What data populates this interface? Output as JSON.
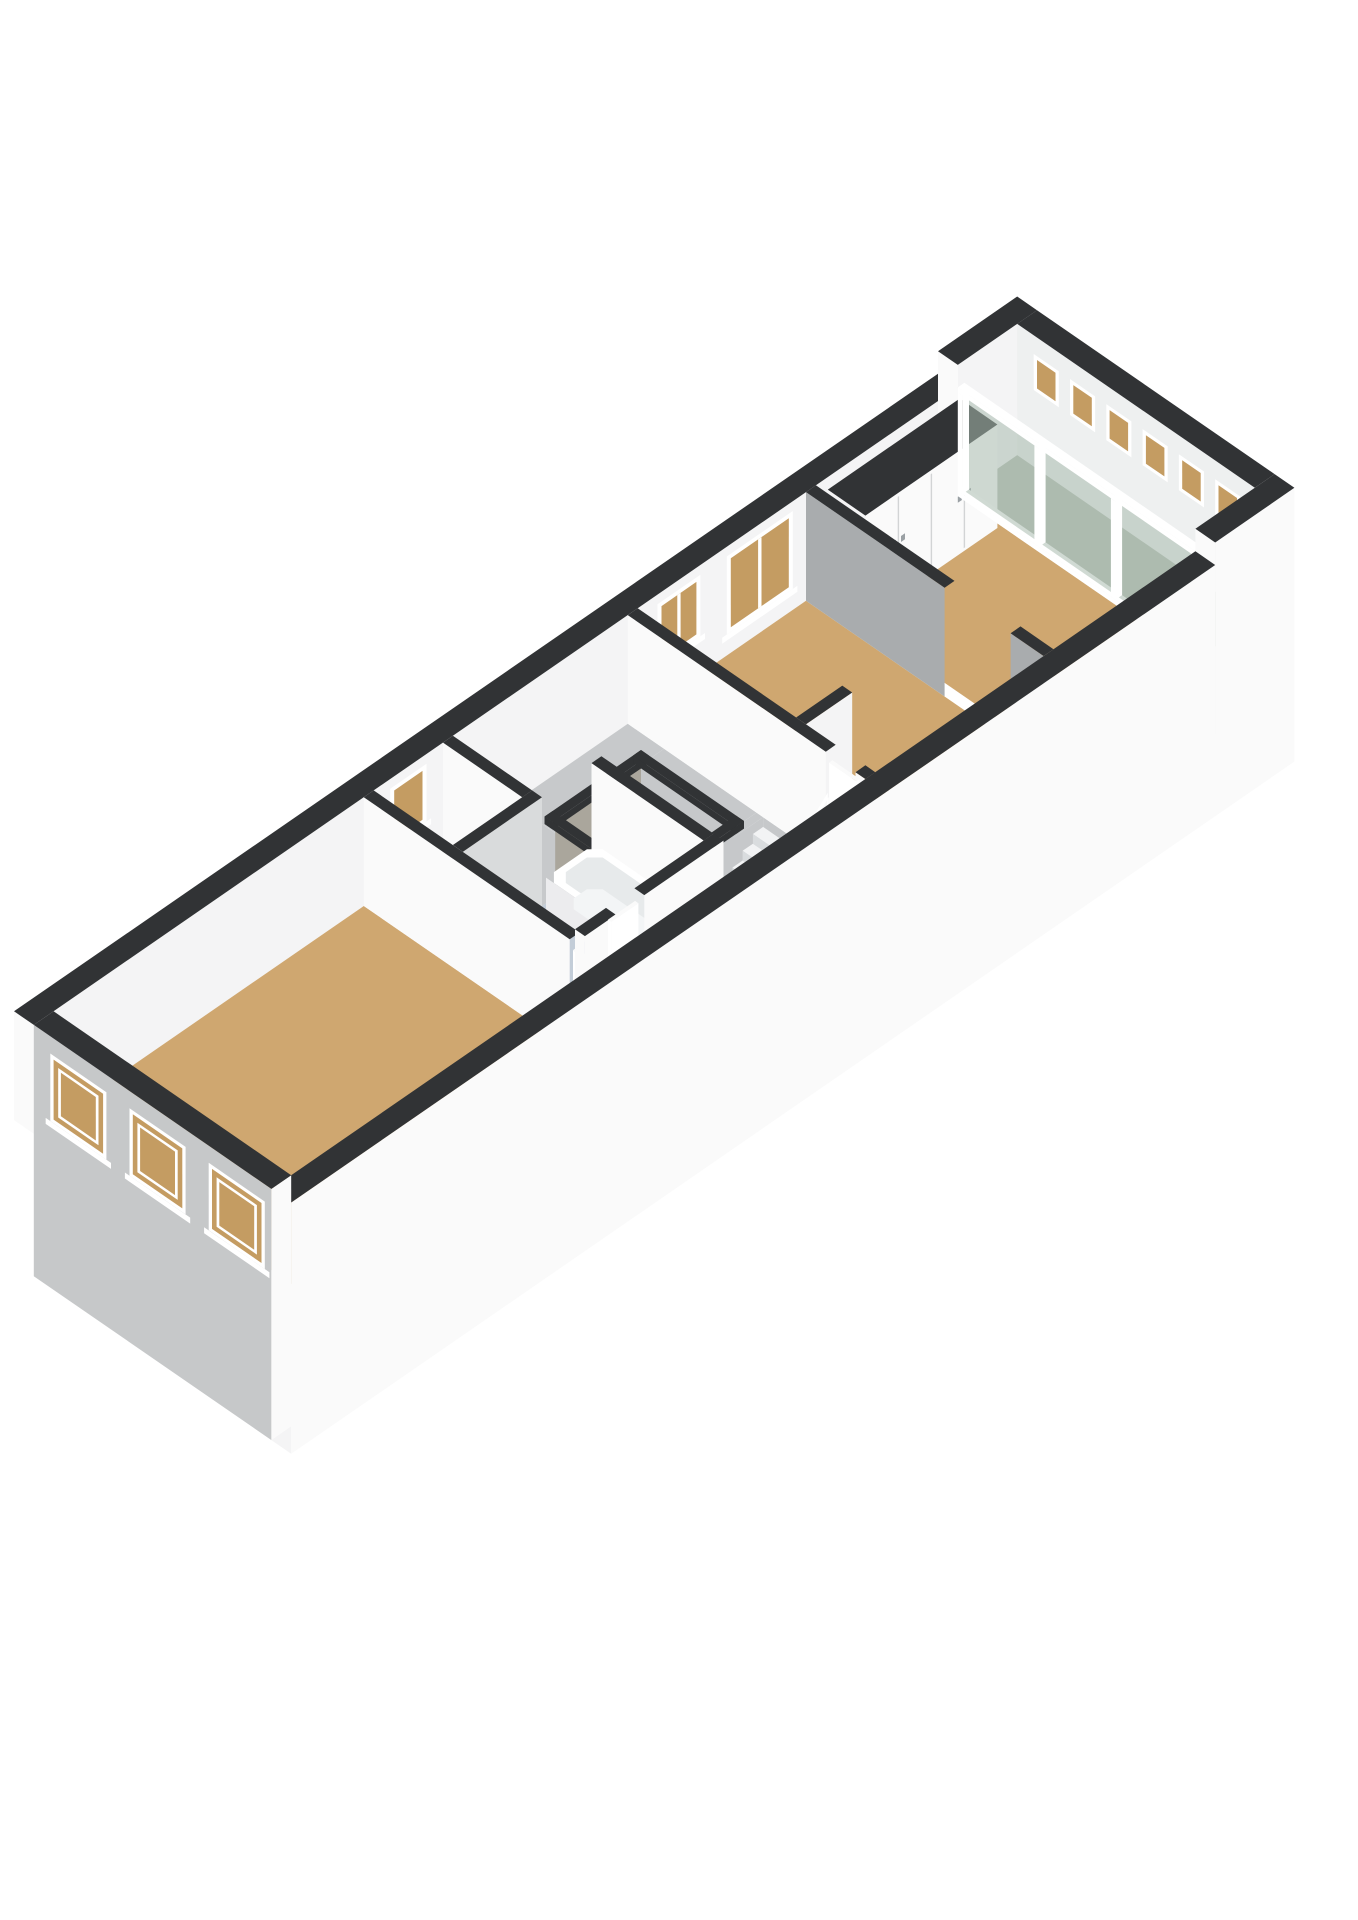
{
  "scene": {
    "width": 1358,
    "height": 1920,
    "background": "#ffffff"
  },
  "projection": {
    "ox": 14,
    "oy": 1120,
    "k": 66,
    "slope": 0.69,
    "hk": 75
  },
  "palette": {
    "capDark": "#313335",
    "wallWhite": "#f4f4f5",
    "wallWhiteB": "#fafafa",
    "wallShadowGray": "#a9acae",
    "wallLightGray": "#d9dbdc",
    "facadeGray": "#c6c8c9",
    "endFaceWhite": "#eef0f0",
    "floorTan": "#cfa770",
    "floorBath": "#c3cdd8",
    "floorToilet": "#b2b4b6",
    "floorGrayHall": "#c7c9cb",
    "floorLoggia": "#b2bab0",
    "pitFloor": "#94979a",
    "pitWall": "#c6c8ca",
    "pitWallB": "#aaa69c",
    "deepPit": "#84878a",
    "glassGreen": "#a9bbae",
    "glassAmber": "#c49c62",
    "tread": "#f2f3f4",
    "riser": "#d9dcde",
    "stairSide": "#e9ebec",
    "white": "#ffffff",
    "handle": "#9aa0a4",
    "doorGap": "#d2d4d5",
    "tubSide": "#fafbfb",
    "tubEnd": "#ececee",
    "tubInner": "#e7eaeb",
    "tubBottom": "#f3f5f6"
  },
  "elements": [
    {
      "type": "wall",
      "name": "ext-wall-top-left-main",
      "axis": "a",
      "a0": 0,
      "a1": 14.0,
      "b0": 0,
      "b1": 0.3,
      "h": 1.45,
      "side": "wallWhite",
      "end": "wallWhiteB",
      "cap": "capDark"
    },
    {
      "type": "wall",
      "name": "ext-wall-top-left-end",
      "axis": "a",
      "a0": 14.0,
      "a1": 15.2,
      "b0": 0,
      "b1": 0.3,
      "h": 1.75,
      "side": "wallWhite",
      "end": "wallWhiteB",
      "cap": "capDark"
    },
    {
      "type": "windowB",
      "name": "toilet-window",
      "b": 0.3,
      "a0": 5.4,
      "a1": 5.95,
      "h0": 0.55,
      "h1": 1.32,
      "mull": 0
    },
    {
      "type": "windowB",
      "name": "bedroom2-window-small",
      "b": 0.3,
      "a0": 9.45,
      "a1": 10.1,
      "h0": 0.5,
      "h1": 1.32,
      "mull": 1
    },
    {
      "type": "windowB",
      "name": "bedroom2-window-large",
      "b": 0.3,
      "a0": 10.5,
      "a1": 11.5,
      "h0": 0.28,
      "h1": 1.32,
      "mull": 1
    },
    {
      "type": "wall",
      "name": "ext-wall-rear-end",
      "axis": "b",
      "a0": 14.9,
      "a1": 15.2,
      "b0": 0.3,
      "b1": 3.9,
      "h": 1.75,
      "side": "endFaceWhite",
      "end": "wallWhiteB",
      "cap": "capDark",
      "ext": 1
    },
    {
      "type": "windowA",
      "name": "transom-window-1",
      "a": 14.9,
      "b0": 0.55,
      "b1": 0.93,
      "h0": 1.02,
      "h1": 1.5
    },
    {
      "type": "windowA",
      "name": "transom-window-2",
      "a": 14.9,
      "b0": 1.1,
      "b1": 1.48,
      "h0": 1.02,
      "h1": 1.5
    },
    {
      "type": "windowA",
      "name": "transom-window-3",
      "a": 14.9,
      "b0": 1.65,
      "b1": 2.03,
      "h0": 1.02,
      "h1": 1.5
    },
    {
      "type": "windowA",
      "name": "transom-window-4",
      "a": 14.9,
      "b0": 2.2,
      "b1": 2.58,
      "h0": 1.02,
      "h1": 1.5
    },
    {
      "type": "windowA",
      "name": "transom-window-5",
      "a": 14.9,
      "b0": 2.75,
      "b1": 3.13,
      "h0": 1.02,
      "h1": 1.5
    },
    {
      "type": "windowA",
      "name": "transom-window-6",
      "a": 14.9,
      "b0": 3.3,
      "b1": 3.68,
      "h0": 1.02,
      "h1": 1.5
    },
    {
      "type": "floor",
      "name": "front-room-floor",
      "a0": 0.3,
      "a1": 5.0,
      "b0": 0.3,
      "b1": 3.9,
      "color": "floorTan"
    },
    {
      "type": "floor",
      "name": "toilet-room-floor",
      "a0": 5.15,
      "a1": 6.2,
      "b0": 0.3,
      "b1": 1.5,
      "color": "floorToilet"
    },
    {
      "type": "floor",
      "name": "bathroom-floor",
      "a0": 5.15,
      "a1": 7.1,
      "b0": 1.65,
      "b1": 3.35,
      "color": "floorBath"
    },
    {
      "type": "floor",
      "name": "front-hall-floor",
      "a0": 5.15,
      "a1": 7.25,
      "b0": 3.5,
      "b1": 3.9,
      "color": "floorTan"
    },
    {
      "type": "floor",
      "name": "mid-corridor-floor",
      "a0": 6.35,
      "a1": 7.25,
      "b0": 0.3,
      "b1": 1.65,
      "color": "floorGrayHall"
    },
    {
      "type": "floor",
      "name": "stairhall-floor-strip-1",
      "a0": 7.25,
      "a1": 9.0,
      "b0": 0.3,
      "b1": 0.85,
      "color": "floorGrayHall"
    },
    {
      "type": "floor",
      "name": "stairhall-floor-strip-2",
      "a0": 7.25,
      "a1": 7.35,
      "b0": 0.85,
      "b1": 2.25,
      "color": "floorGrayHall"
    },
    {
      "type": "floor",
      "name": "stairhall-floor-strip-3",
      "a0": 8.65,
      "a1": 9.0,
      "b0": 0.85,
      "b1": 2.25,
      "color": "floorGrayHall"
    },
    {
      "type": "floor",
      "name": "stairhall-floor-strip-4",
      "a0": 7.25,
      "a1": 9.0,
      "b0": 2.25,
      "b1": 2.35,
      "color": "floorGrayHall"
    },
    {
      "type": "floor",
      "name": "stairhall-floor-strip-5",
      "a0": 7.25,
      "a1": 7.6,
      "b0": 2.35,
      "b1": 3.3,
      "color": "floorGrayHall"
    },
    {
      "type": "floor",
      "name": "stair-landing-floor",
      "a0": 7.25,
      "a1": 9.0,
      "b0": 3.3,
      "b1": 3.9,
      "color": "floorTan"
    },
    {
      "type": "floor",
      "name": "bedroom2-floor",
      "a0": 9.15,
      "a1": 11.7,
      "b0": 0.3,
      "b1": 3.9,
      "color": "floorTan"
    },
    {
      "type": "floor",
      "name": "bedroom3-floor",
      "a0": 11.85,
      "a1": 14.0,
      "b0": 0.3,
      "b1": 3.9,
      "color": "floorTan"
    },
    {
      "type": "floor",
      "name": "loggia-floor",
      "a0": 14.1,
      "a1": 14.9,
      "b0": 0.3,
      "b1": 3.9,
      "color": "floorLoggia"
    },
    {
      "type": "voidshaft",
      "name": "vide-opening",
      "a0": 7.35,
      "a1": 8.65,
      "b0": 0.85,
      "b1": 2.25,
      "depth": 0.8
    },
    {
      "type": "stairwell",
      "name": "stairwell-opening",
      "a0": 7.6,
      "a1": 9.0,
      "b0": 2.35,
      "b1": 3.3,
      "depth": 1.05
    },
    {
      "type": "closet",
      "name": "wardrobe-closet",
      "a0": 11.95,
      "a1": 13.95,
      "b0": 0.38,
      "b1": 0.95,
      "h": 1.38
    },
    {
      "type": "glasswall",
      "name": "loggia-glass-wall",
      "a0": 14.0,
      "a1": 14.1,
      "b0": 0.3,
      "b1": 3.9,
      "h": 1.45
    },
    {
      "type": "wall",
      "name": "wall-bedroom3-divider",
      "axis": "b",
      "a0": 11.7,
      "a1": 11.85,
      "b0": 0.3,
      "b1": 3.9,
      "h": 1.45,
      "side": "wallShadowGray",
      "end": "wallWhite",
      "cap": "capDark",
      "open": [
        [
          2.4,
          3.4
        ]
      ]
    },
    {
      "type": "wall",
      "name": "bedroom2-closet-stub",
      "axis": "a",
      "a0": 9.15,
      "a1": 9.85,
      "b0": 2.7,
      "b1": 2.85,
      "h": 1.45,
      "side": "wallWhite",
      "end": "wallWhiteB",
      "cap": "capDark"
    },
    {
      "type": "wall",
      "name": "wall-stairhall-bedroom2",
      "axis": "b",
      "a0": 9.0,
      "a1": 9.15,
      "b0": 0.3,
      "b1": 3.9,
      "h": 1.45,
      "side": "wallWhiteB",
      "end": "wallWhite",
      "cap": "capDark",
      "open": [
        [
          3.3,
          3.75
        ]
      ]
    },
    {
      "type": "doorleaf",
      "name": "bedroom2-door",
      "axis": "b",
      "a0": 9.03,
      "a1": 9.08,
      "b0": 3.32,
      "b1": 3.73,
      "h": 1.3
    },
    {
      "type": "stairs",
      "name": "staircase",
      "aTop": 9.0,
      "b0": 2.35,
      "b1": 3.3,
      "n": 8,
      "rise": 0.13,
      "run": 0.155
    },
    {
      "type": "balustrade",
      "name": "stair-balustrade",
      "aTop": 9.02,
      "aBot": 7.68,
      "b": 3.31,
      "posts": 10
    },
    {
      "type": "wall",
      "name": "wall-toilet-right",
      "axis": "b",
      "a0": 6.2,
      "a1": 6.35,
      "b0": 0.3,
      "b1": 1.5,
      "h": 1.45,
      "side": "wallWhiteB",
      "end": "wallWhite",
      "cap": "capDark"
    },
    {
      "type": "sink",
      "name": "toilet-sink",
      "a0": 5.5,
      "a1": 5.85,
      "b0": 0.32,
      "b1": 0.58,
      "h": 0.55
    },
    {
      "type": "wall",
      "name": "wall-bathroom-right",
      "axis": "b",
      "a0": 7.1,
      "a1": 7.25,
      "b0": 1.65,
      "b1": 3.35,
      "h": 1.45,
      "side": "wallWhiteB",
      "end": "wallWhite",
      "cap": "capDark"
    },
    {
      "type": "toilet",
      "name": "toilet-bowl",
      "cx": 5.62,
      "cy": 0.86,
      "r": 0.19,
      "hTop": 0.4,
      "tank": [
        5.25,
        5.45,
        0.68,
        1.04,
        0.52
      ]
    },
    {
      "type": "wall",
      "name": "wall-toilet-bathroom",
      "axis": "a",
      "a0": 5.15,
      "a1": 6.35,
      "b0": 1.5,
      "b1": 1.65,
      "h": 1.45,
      "side": "wallLightGray",
      "end": "wallWhiteB",
      "cap": "capDark"
    },
    {
      "type": "tub",
      "name": "bathtub",
      "a0": 6.28,
      "a1": 7.02,
      "b0": 1.78,
      "b1": 3.27,
      "h": 0.5
    },
    {
      "type": "wall",
      "name": "wall-frontroom-divider",
      "axis": "b",
      "a0": 5.0,
      "a1": 5.15,
      "b0": 0.3,
      "b1": 3.9,
      "h": 1.45,
      "side": "wallWhiteB",
      "end": "wallWhite",
      "cap": "capDark",
      "open": [
        [
          3.42,
          3.85
        ]
      ]
    },
    {
      "type": "doorleaf",
      "name": "frontroom-door",
      "axis": "b",
      "a0": 5.03,
      "a1": 5.08,
      "b0": 3.44,
      "b1": 3.83,
      "h": 1.3
    },
    {
      "type": "wall",
      "name": "wall-bathroom-hall",
      "axis": "a",
      "a0": 5.15,
      "a1": 7.25,
      "b0": 3.35,
      "b1": 3.5,
      "h": 1.45,
      "side": "wallWhiteB",
      "end": "wallWhiteB",
      "cap": "capDark",
      "open": [
        [
          5.62,
          6.05
        ]
      ]
    },
    {
      "type": "doorleaf",
      "name": "bathroom-door",
      "axis": "a",
      "a0": 5.63,
      "a1": 6.04,
      "b0": 3.37,
      "b1": 3.42,
      "h": 1.3
    },
    {
      "type": "wall",
      "name": "ext-wall-bottom-right-end",
      "axis": "a",
      "a0": 14.0,
      "a1": 15.2,
      "b0": 3.9,
      "b1": 4.2,
      "h": 1.75,
      "side": "wallWhiteB",
      "end": "wallWhiteB",
      "cap": "capDark",
      "ext": 1
    },
    {
      "type": "wall",
      "name": "ext-wall-bottom-right-main",
      "axis": "a",
      "a0": 0,
      "a1": 14.0,
      "b0": 3.9,
      "b1": 4.2,
      "h": 1.45,
      "side": "wallWhiteB",
      "end": "wallWhite",
      "cap": "capDark",
      "ext": 1
    },
    {
      "type": "wall",
      "name": "ext-wall-front-facade",
      "axis": "b",
      "a0": 0,
      "a1": 0.3,
      "b0": 0.3,
      "b1": 3.9,
      "h": 1.45,
      "side": "facadeGray",
      "end": "wallWhiteB",
      "cap": "capDark",
      "ext": 1
    },
    {
      "type": "windowA",
      "name": "facade-window-1",
      "a": 0,
      "b0": 0.55,
      "b1": 1.4,
      "h0": 0.32,
      "h1": 1.22,
      "sill": 1,
      "sash": 1
    },
    {
      "type": "windowA",
      "name": "facade-window-2",
      "a": 0,
      "b0": 1.75,
      "b1": 2.6,
      "h0": 0.32,
      "h1": 1.22,
      "sill": 1,
      "sash": 1
    },
    {
      "type": "windowA",
      "name": "facade-window-3",
      "a": 0,
      "b0": 2.95,
      "b1": 3.8,
      "h0": 0.32,
      "h1": 1.22,
      "sill": 1,
      "sash": 1
    }
  ]
}
